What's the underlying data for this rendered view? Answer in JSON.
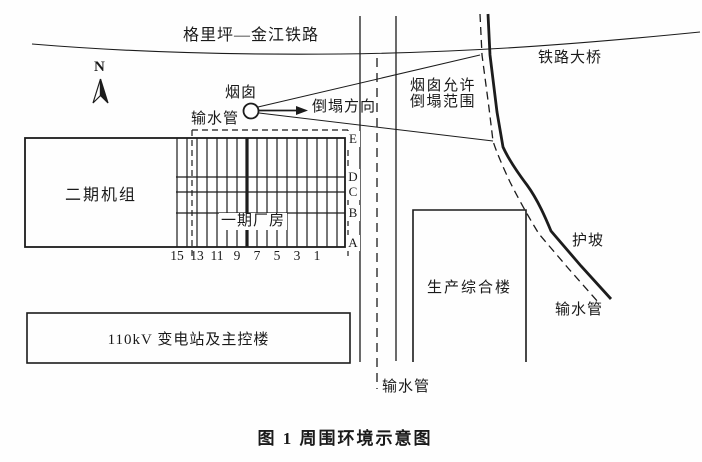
{
  "figure": {
    "caption": "图 1  周围环境示意图",
    "background_color": "#fefefe",
    "line_color": "#1c1c1c"
  },
  "labels": {
    "railway": "格里坪—金江铁路",
    "railway_bridge": "铁路大桥",
    "compass_north": "N",
    "chimney": "烟囱",
    "collapse_direction": "倒塌方向",
    "collapse_zone_line1": "烟囱允许",
    "collapse_zone_line2": "倒塌范围",
    "water_pipe_top": "输水管",
    "water_pipe_bottom": "输水管",
    "water_pipe_right": "输水管",
    "slope_protection": "护坡",
    "phase2_units": "二期机组",
    "phase1_plant": "一期厂房",
    "substation": "110kV 变电站及主控楼",
    "production_building": "生产综合楼"
  },
  "grid": {
    "column_labels": [
      "15",
      "13",
      "11",
      "9",
      "7",
      "5",
      "3",
      "1"
    ],
    "row_labels": [
      "E",
      "D",
      "C",
      "B",
      "A"
    ]
  }
}
